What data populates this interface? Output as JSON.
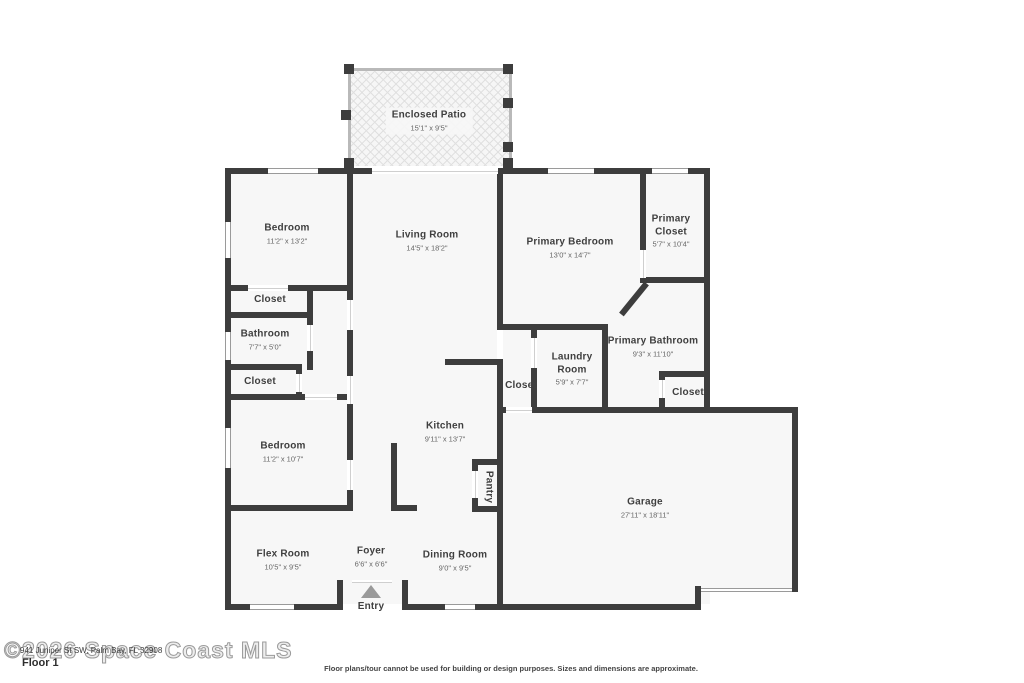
{
  "floorplan": {
    "rooms": [
      {
        "id": "patio",
        "name": "Enclosed Patio",
        "dims": "15'1\" x 9'5\""
      },
      {
        "id": "bedroom1",
        "name": "Bedroom",
        "dims": "11'2\" x 13'2\""
      },
      {
        "id": "living",
        "name": "Living Room",
        "dims": "14'5\" x 18'2\""
      },
      {
        "id": "primary-bedroom",
        "name": "Primary Bedroom",
        "dims": "13'0\" x 14'7\""
      },
      {
        "id": "primary-closet",
        "name": "Primary Closet",
        "dims": "5'7\" x 10'4\""
      },
      {
        "id": "closet1",
        "name": "Closet",
        "dims": ""
      },
      {
        "id": "bathroom",
        "name": "Bathroom",
        "dims": "7'7\" x 5'0\""
      },
      {
        "id": "closet2",
        "name": "Closet",
        "dims": ""
      },
      {
        "id": "bedroom2",
        "name": "Bedroom",
        "dims": "11'2\" x 10'7\""
      },
      {
        "id": "kitchen",
        "name": "Kitchen",
        "dims": "9'11\" x 13'7\""
      },
      {
        "id": "laundry",
        "name": "Laundry Room",
        "dims": "5'9\" x 7'7\""
      },
      {
        "id": "primary-bathroom",
        "name": "Primary Bathroom",
        "dims": "9'3\" x 11'10\""
      },
      {
        "id": "hall-closet",
        "name": "Closet",
        "dims": ""
      },
      {
        "id": "bath-closet",
        "name": "Closet",
        "dims": ""
      },
      {
        "id": "pantry",
        "name": "Pantry",
        "dims": ""
      },
      {
        "id": "garage",
        "name": "Garage",
        "dims": "27'11\" x 18'11\""
      },
      {
        "id": "flex",
        "name": "Flex Room",
        "dims": "10'5\" x 9'5\""
      },
      {
        "id": "foyer",
        "name": "Foyer",
        "dims": "6'6\" x 6'6\""
      },
      {
        "id": "dining",
        "name": "Dining Room",
        "dims": "9'0\" x 9'5\""
      },
      {
        "id": "entry",
        "name": "Entry",
        "dims": ""
      }
    ]
  },
  "footer": {
    "watermark": "©2026 Space Coast MLS",
    "address": "941 Juniper St SW, Palm Bay, FL 32908",
    "floor_label": "Floor 1",
    "disclaimer": "Floor plans/tour cannot be used for building or design purposes. Sizes and dimensions are approximate."
  },
  "colors": {
    "wall": "#3d3d3d",
    "room_fill": "#f7f7f7",
    "label": "#3f3f3f",
    "dims": "#666666",
    "entry_arrow": "#9a9a9a"
  }
}
